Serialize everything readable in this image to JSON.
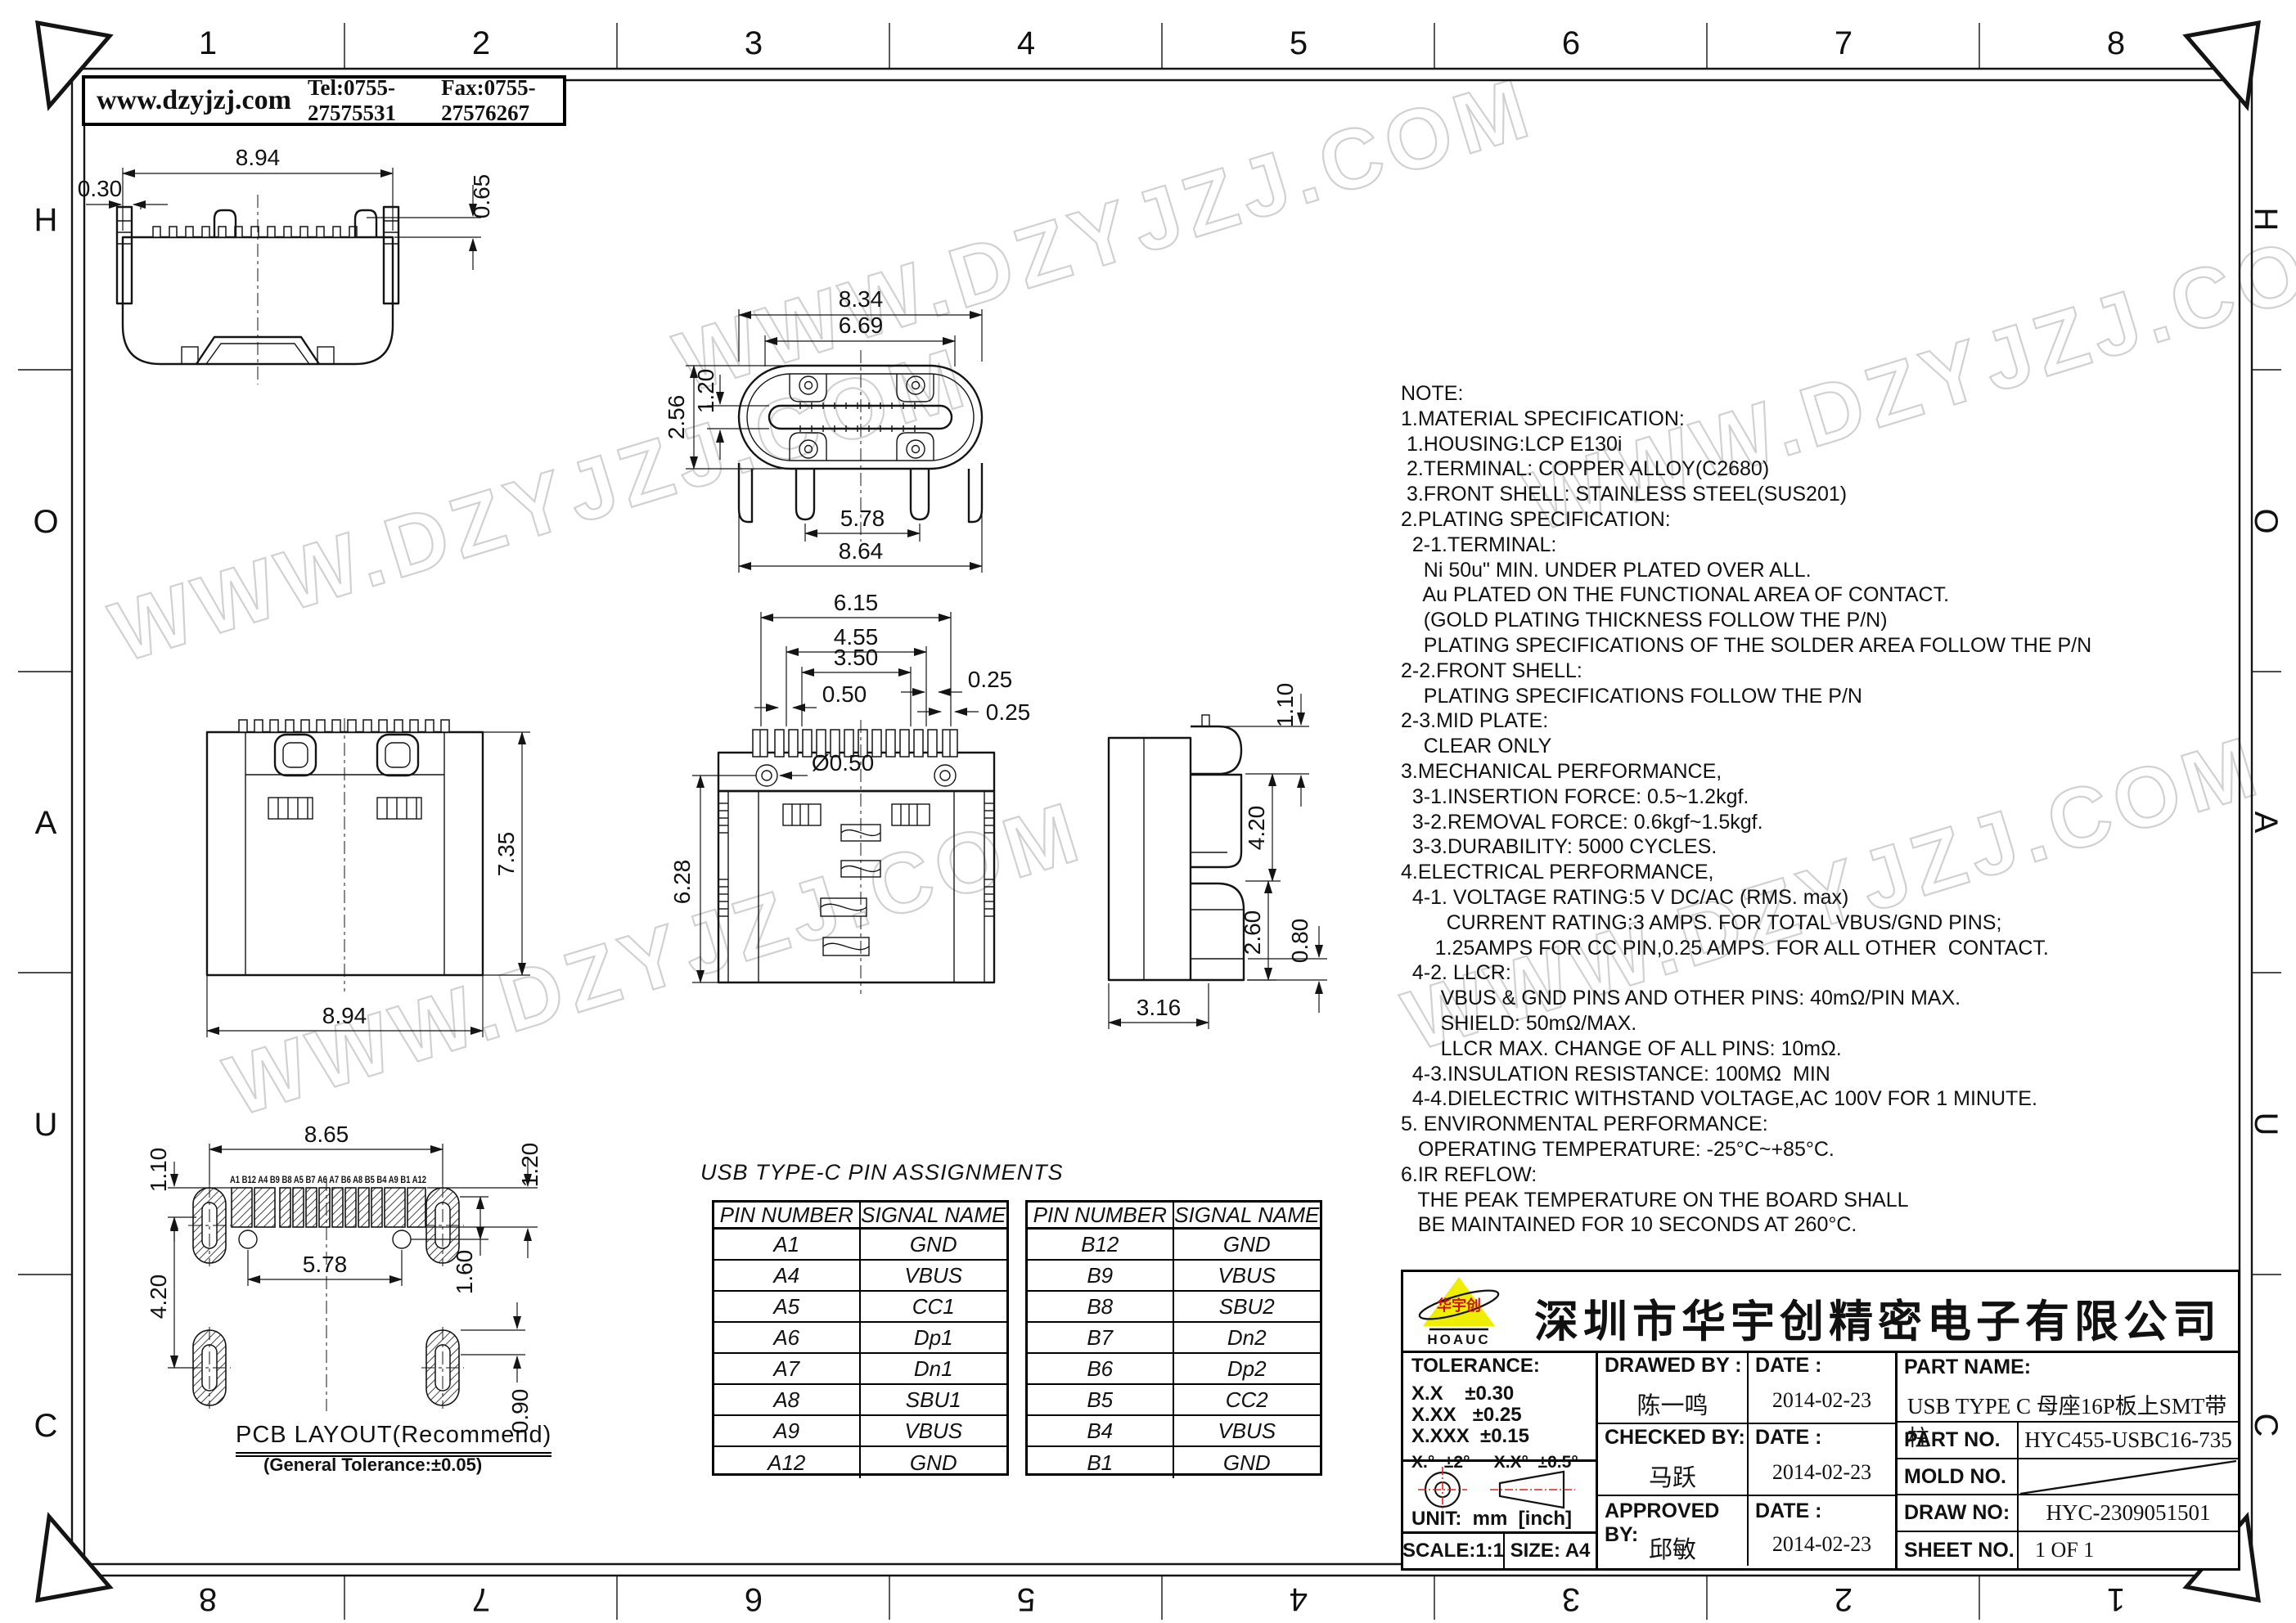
{
  "banner": {
    "site": "www.dzyjzj.com",
    "tel": "Tel:0755-27575531",
    "fax": "Fax:0755-27576267"
  },
  "frame": {
    "cols": [
      "1",
      "2",
      "3",
      "4",
      "5",
      "6",
      "7",
      "8"
    ],
    "rows": [
      "H",
      "O",
      "A",
      "U",
      "C"
    ]
  },
  "watermark": {
    "text": "WWW.DZYJZJ.COM"
  },
  "dims": {
    "v1_w": "8.94",
    "v1_off": "0.30",
    "v1_h": "0.65",
    "v2_a": "8.34",
    "v2_b": "6.69",
    "v2_c": "2.56",
    "v2_d": "1.20",
    "v2_e": "5.78",
    "v2_f": "8.64",
    "v3_h": "7.35",
    "v3_w": "8.94",
    "v4_a": "6.15",
    "v4_b": "4.55",
    "v4_c": "3.50",
    "v4_d": "0.50",
    "v4_e": "0.25",
    "v4_f": "0.25",
    "v4_hole": "Ø0.50",
    "v4_h": "6.28",
    "v5_a": "1.10",
    "v5_b": "4.20",
    "v5_c": "2.60",
    "v5_d": "0.80",
    "v5_e": "3.16",
    "p_w": "8.65",
    "p_a": "1.10",
    "p_b": "4.20",
    "p_c": "5.78",
    "p_d": "1.60",
    "p_e": "1.20",
    "p_f": "0.90"
  },
  "pcb": {
    "title": "PCB LAYOUT(Recommend)",
    "subtitle": "(General Tolerance:±0.05)",
    "pads": "A1 B12 A4 B9  B8  A5  B7  A6  A7  B6  A8  B5  B4 A9  B1 A12"
  },
  "pin_table": {
    "title": "USB TYPE-C PIN ASSIGNMENTS",
    "col1": "PIN NUMBER",
    "col2": "SIGNAL NAME",
    "left": [
      [
        "A1",
        "GND"
      ],
      [
        "A4",
        "VBUS"
      ],
      [
        "A5",
        "CC1"
      ],
      [
        "A6",
        "Dp1"
      ],
      [
        "A7",
        "Dn1"
      ],
      [
        "A8",
        "SBU1"
      ],
      [
        "A9",
        "VBUS"
      ],
      [
        "A12",
        "GND"
      ]
    ],
    "right": [
      [
        "B12",
        "GND"
      ],
      [
        "B9",
        "VBUS"
      ],
      [
        "B8",
        "SBU2"
      ],
      [
        "B7",
        "Dn2"
      ],
      [
        "B6",
        "Dp2"
      ],
      [
        "B5",
        "CC2"
      ],
      [
        "B4",
        "VBUS"
      ],
      [
        "B1",
        "GND"
      ]
    ]
  },
  "notes": {
    "text": "NOTE:\n1.MATERIAL SPECIFICATION:\n 1.HOUSING:LCP E130i\n 2.TERMINAL: COPPER ALLOY(C2680)\n 3.FRONT SHELL: STAINLESS STEEL(SUS201)\n2.PLATING SPECIFICATION:\n  2-1.TERMINAL:\n    Ni 50u\" MIN. UNDER PLATED OVER ALL.\n    Au PLATED ON THE FUNCTIONAL AREA OF CONTACT.\n    (GOLD PLATING THICKNESS FOLLOW THE P/N)\n    PLATING SPECIFICATIONS OF THE SOLDER AREA FOLLOW THE P/N\n2-2.FRONT SHELL:\n    PLATING SPECIFICATIONS FOLLOW THE P/N\n2-3.MID PLATE:\n    CLEAR ONLY\n3.MECHANICAL PERFORMANCE,\n  3-1.INSERTION FORCE: 0.5~1.2kgf.\n  3-2.REMOVAL FORCE: 0.6kgf~1.5kgf.\n  3-3.DURABILITY: 5000 CYCLES.\n4.ELECTRICAL PERFORMANCE,\n  4-1. VOLTAGE RATING:5 V DC/AC (RMS. max)\n        CURRENT RATING:3 AMPS. FOR TOTAL VBUS/GND PINS;\n      1.25AMPS FOR CC PIN,0.25 AMPS. FOR ALL OTHER  CONTACT.\n  4-2. LLCR:\n       VBUS & GND PINS AND OTHER PINS: 40mΩ/PIN MAX.\n       SHIELD: 50mΩ/MAX.\n       LLCR MAX. CHANGE OF ALL PINS: 10mΩ.\n  4-3.INSULATION RESISTANCE: 100MΩ  MIN\n  4-4.DIELECTRIC WITHSTAND VOLTAGE,AC 100V FOR 1 MINUTE.\n5. ENVIRONMENTAL PERFORMANCE:\n   OPERATING TEMPERATURE: -25°C~+85°C.\n6.IR REFLOW:\n   THE PEAK TEMPERATURE ON THE BOARD SHALL\n   BE MAINTAINED FOR 10 SECONDS AT 260°C."
  },
  "title_block": {
    "company": "深圳市华宇创精密电子有限公司",
    "logo_text": "HOAUC",
    "logo_cn": "华宇创",
    "tol_title": "TOLERANCE:",
    "tol1": "X.X    ±0.30",
    "tol2": "X.XX   ±0.25",
    "tol3": "X.XXX  ±0.15",
    "tol4": "X.°  ±2°     X.X°  ±0.5°",
    "unit": "UNIT:  mm  [inch]",
    "scale": "SCALE:1:1",
    "size": "SIZE:  A4",
    "drawn_label": "DRAWED BY :",
    "drawn": "陈一鸣",
    "checked_label": "CHECKED BY:",
    "checked": "马跃",
    "approved_label": "APPROVED BY:",
    "approved": "邱敏",
    "date_label": "DATE :",
    "date1": "2014-02-23",
    "date2": "2014-02-23",
    "date3": "2014-02-23",
    "part_name_label": "PART NAME:",
    "part_name": "USB TYPE C 母座16P板上SMT带柱",
    "part_no_label": "PART NO.",
    "part_no": "HYC455-USBC16-735",
    "mold_no_label": "MOLD NO.",
    "draw_no_label": "DRAW NO:",
    "draw_no": "HYC-2309051501",
    "sheet_label": "SHEET NO.",
    "sheet": "1 OF 1"
  }
}
